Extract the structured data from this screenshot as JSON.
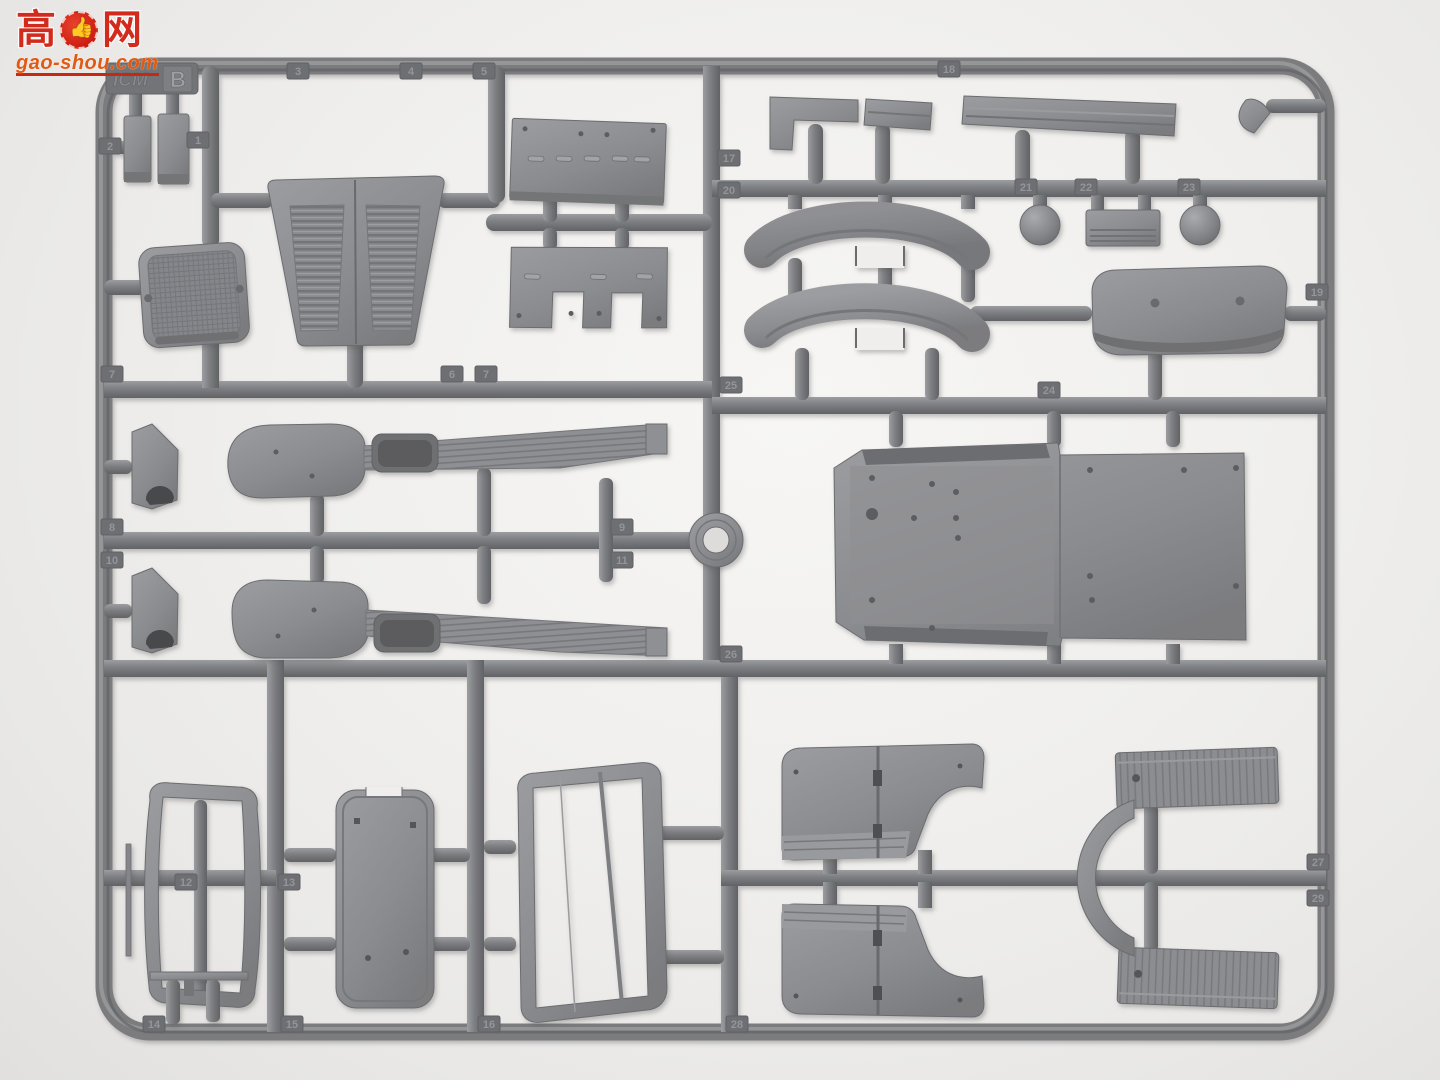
{
  "watermark": {
    "char_left": "高",
    "char_right": "网",
    "thumb_icon": "👍",
    "domain": "gao-shou.com",
    "red": "#d32a1e",
    "orange": "#e05a14"
  },
  "sprue": {
    "brand_embossed": "ICM",
    "letter": "B",
    "plastic_color": "#8d8e91"
  },
  "part_number_tabs": [
    {
      "label": "2",
      "x": 110,
      "y": 146
    },
    {
      "label": "1",
      "x": 198,
      "y": 140
    },
    {
      "label": "3",
      "x": 298,
      "y": 71
    },
    {
      "label": "4",
      "x": 411,
      "y": 71
    },
    {
      "label": "5",
      "x": 484,
      "y": 71
    },
    {
      "label": "18",
      "x": 949,
      "y": 69
    },
    {
      "label": "17",
      "x": 729,
      "y": 158
    },
    {
      "label": "20",
      "x": 729,
      "y": 190
    },
    {
      "label": "21",
      "x": 1026,
      "y": 187
    },
    {
      "label": "22",
      "x": 1086,
      "y": 187
    },
    {
      "label": "23",
      "x": 1189,
      "y": 187
    },
    {
      "label": "19",
      "x": 1317,
      "y": 292
    },
    {
      "label": "7",
      "x": 112,
      "y": 374
    },
    {
      "label": "6",
      "x": 452,
      "y": 374
    },
    {
      "label": "7",
      "x": 486,
      "y": 374
    },
    {
      "label": "25",
      "x": 731,
      "y": 385
    },
    {
      "label": "24",
      "x": 1049,
      "y": 390
    },
    {
      "label": "8",
      "x": 112,
      "y": 527
    },
    {
      "label": "10",
      "x": 112,
      "y": 560
    },
    {
      "label": "9",
      "x": 622,
      "y": 527
    },
    {
      "label": "11",
      "x": 622,
      "y": 560
    },
    {
      "label": "26",
      "x": 731,
      "y": 654
    },
    {
      "label": "12",
      "x": 186,
      "y": 882
    },
    {
      "label": "13",
      "x": 289,
      "y": 882
    },
    {
      "label": "14",
      "x": 154,
      "y": 1024
    },
    {
      "label": "15",
      "x": 292,
      "y": 1024
    },
    {
      "label": "16",
      "x": 489,
      "y": 1024
    },
    {
      "label": "28",
      "x": 737,
      "y": 1024
    },
    {
      "label": "27",
      "x": 1318,
      "y": 862
    },
    {
      "label": "29",
      "x": 1318,
      "y": 898
    }
  ]
}
